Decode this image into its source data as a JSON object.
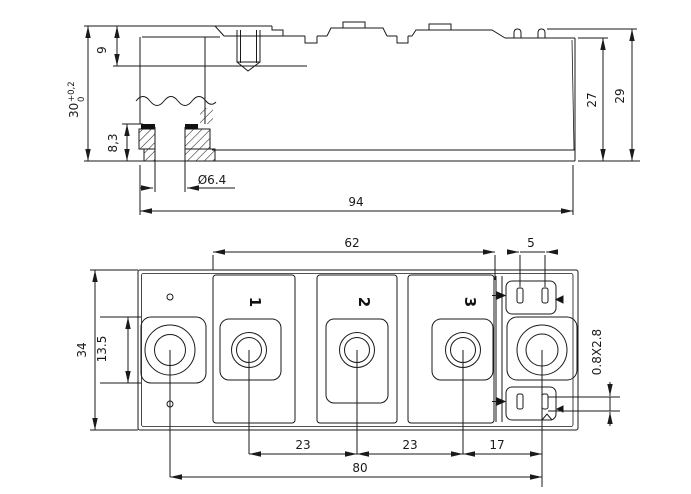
{
  "colors": {
    "ink": "#1a1a1a",
    "background": "#ffffff"
  },
  "icons": {
    "tab_marker": "►"
  },
  "side_view": {
    "dim_9": "9",
    "dim_30": "30",
    "dim_30_tol_plus": "+0,2",
    "dim_30_tol_minus": "0",
    "dim_8_3": "8,3",
    "dim_hole": "Ø6.4",
    "dim_94": "94",
    "dim_27": "27",
    "dim_29": "29"
  },
  "plan_view": {
    "dim_62": "62",
    "dim_5": "5",
    "dim_34": "34",
    "dim_13_5": "13.5",
    "dim_slot": "0.8X2.8",
    "dim_23_left": "23",
    "dim_23_right": "23",
    "dim_17": "17",
    "dim_80": "80",
    "terminals": [
      "1",
      "2",
      "3"
    ]
  }
}
